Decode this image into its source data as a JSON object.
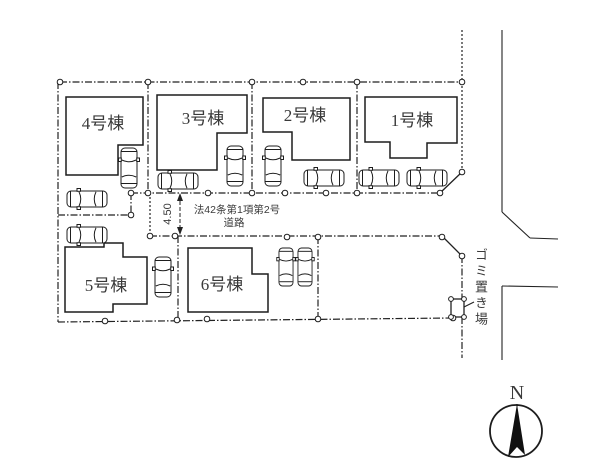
{
  "plan": {
    "buildings": {
      "b1": "1号棟",
      "b2": "2号棟",
      "b3": "3号棟",
      "b4": "4号棟",
      "b5": "5号棟",
      "b6": "6号棟"
    },
    "road": {
      "name_line1": "法42条第1項第2号",
      "name_line2": "道路",
      "width_dimension": "4.50"
    },
    "garbage_station": "ゴミ置き場",
    "compass_north": "N"
  },
  "colors": {
    "line": "#222222",
    "text": "#3a3a3a",
    "background": "#ffffff"
  }
}
